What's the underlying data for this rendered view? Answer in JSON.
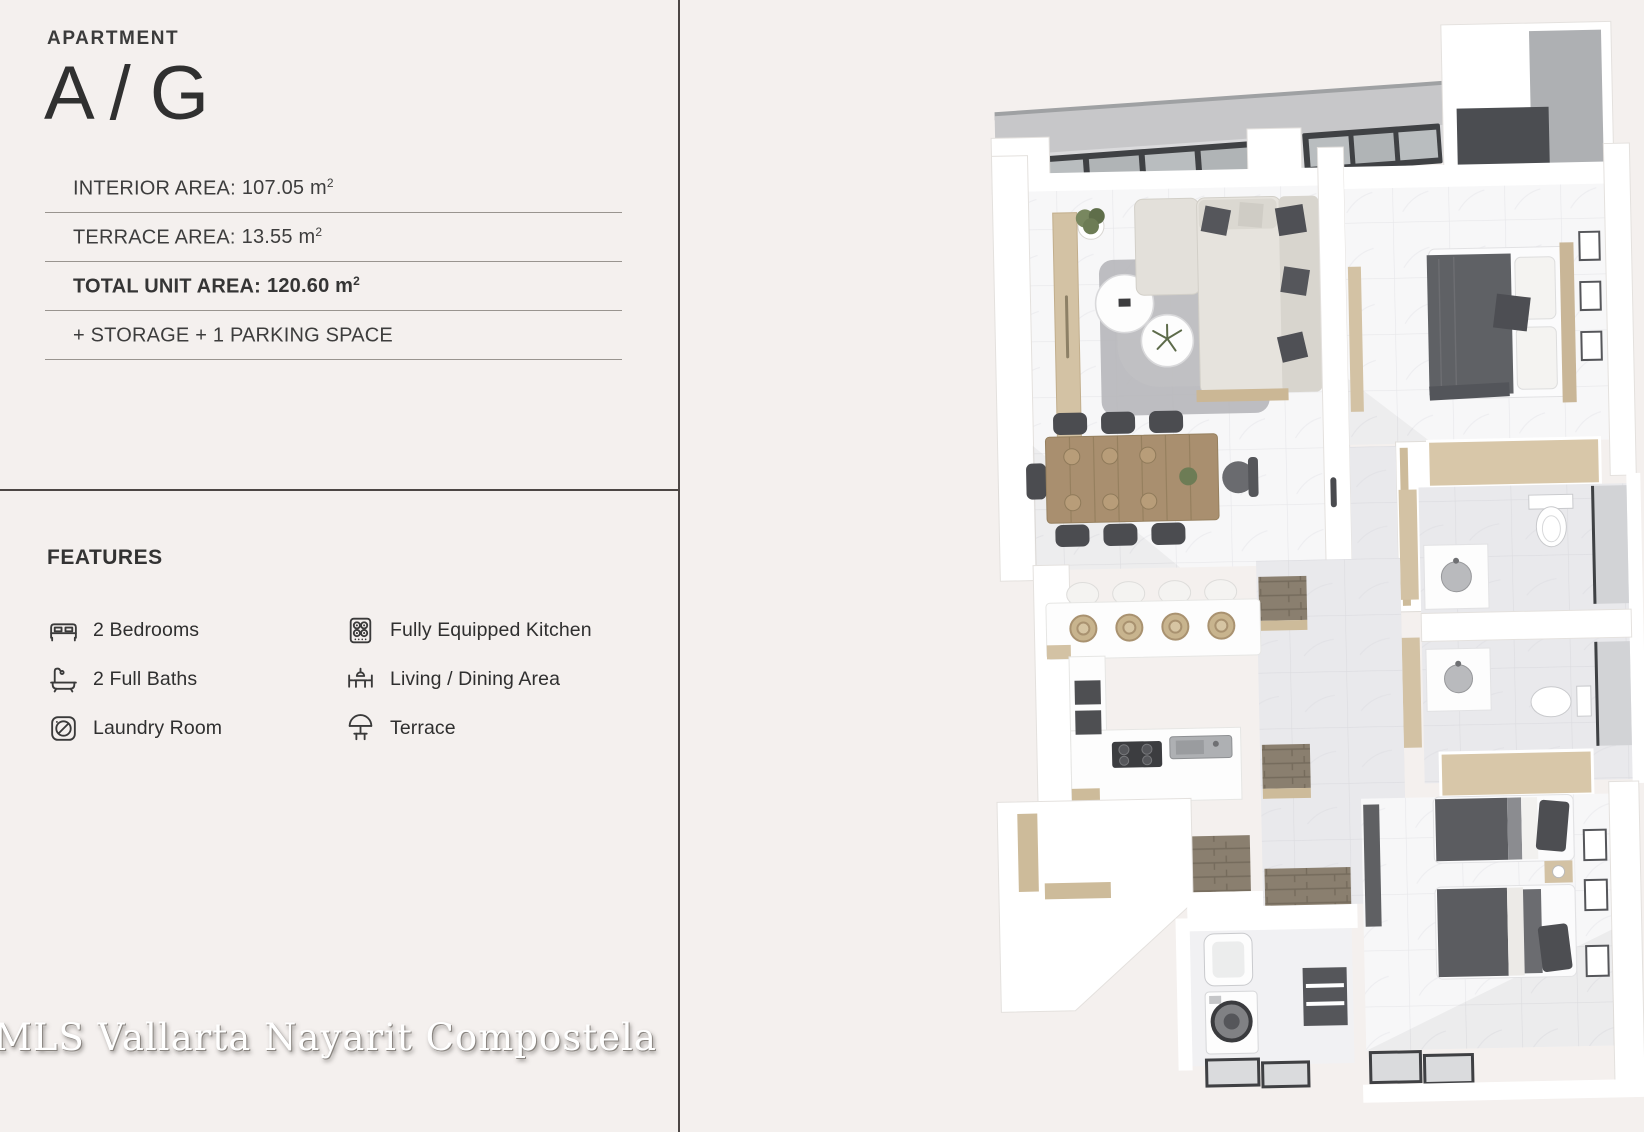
{
  "palette": {
    "page-bg": "#f4f0ee",
    "text": "#3b3b3b",
    "rule": "#99948f",
    "divider": "#4c4644",
    "watermark-shadow": "#8a8580",
    "plan-wall": "#ffffff",
    "plan-wood": "#d3c2a4",
    "plan-dark-frame": "#3f4144",
    "plan-fabric": "#5d5e62",
    "plan-marble": "#f7f7f8"
  },
  "header": {
    "eyebrow": "APARTMENT",
    "unit_name": "A / G"
  },
  "specs": {
    "rows": [
      {
        "label": "INTERIOR AREA:",
        "value": "107.05 m",
        "sup": "2",
        "emphasis": false
      },
      {
        "label": "TERRACE AREA:",
        "value": "13.55 m",
        "sup": "2",
        "emphasis": false
      },
      {
        "label": "TOTAL UNIT AREA:",
        "value": "120.60 m",
        "sup": "2",
        "emphasis": true
      },
      {
        "label": "+ STORAGE + 1 PARKING SPACE",
        "value": "",
        "sup": "",
        "emphasis": false
      }
    ]
  },
  "features": {
    "title": "FEATURES",
    "left_column": [
      {
        "icon": "bed-icon",
        "label": "2 Bedrooms"
      },
      {
        "icon": "bathtub-icon",
        "label": "2 Full Baths"
      },
      {
        "icon": "washing-machine-icon",
        "label": "Laundry Room"
      }
    ],
    "right_column": [
      {
        "icon": "stove-icon",
        "label": "Fully Equipped Kitchen"
      },
      {
        "icon": "dining-table-icon",
        "label": "Living / Dining Area"
      },
      {
        "icon": "terrace-umbrella-icon",
        "label": "Terrace"
      }
    ]
  },
  "watermark": "MLS Vallarta Nayarit Compostela",
  "floor_plan": {
    "type": "3d-top-down-rendering",
    "visible_rooms": [
      "Terrace",
      "Living Room",
      "Dining Area",
      "Kitchen",
      "Master Bedroom",
      "Bathroom",
      "Bathroom",
      "Hallway",
      "Laundry Room",
      "Second Bedroom"
    ]
  }
}
